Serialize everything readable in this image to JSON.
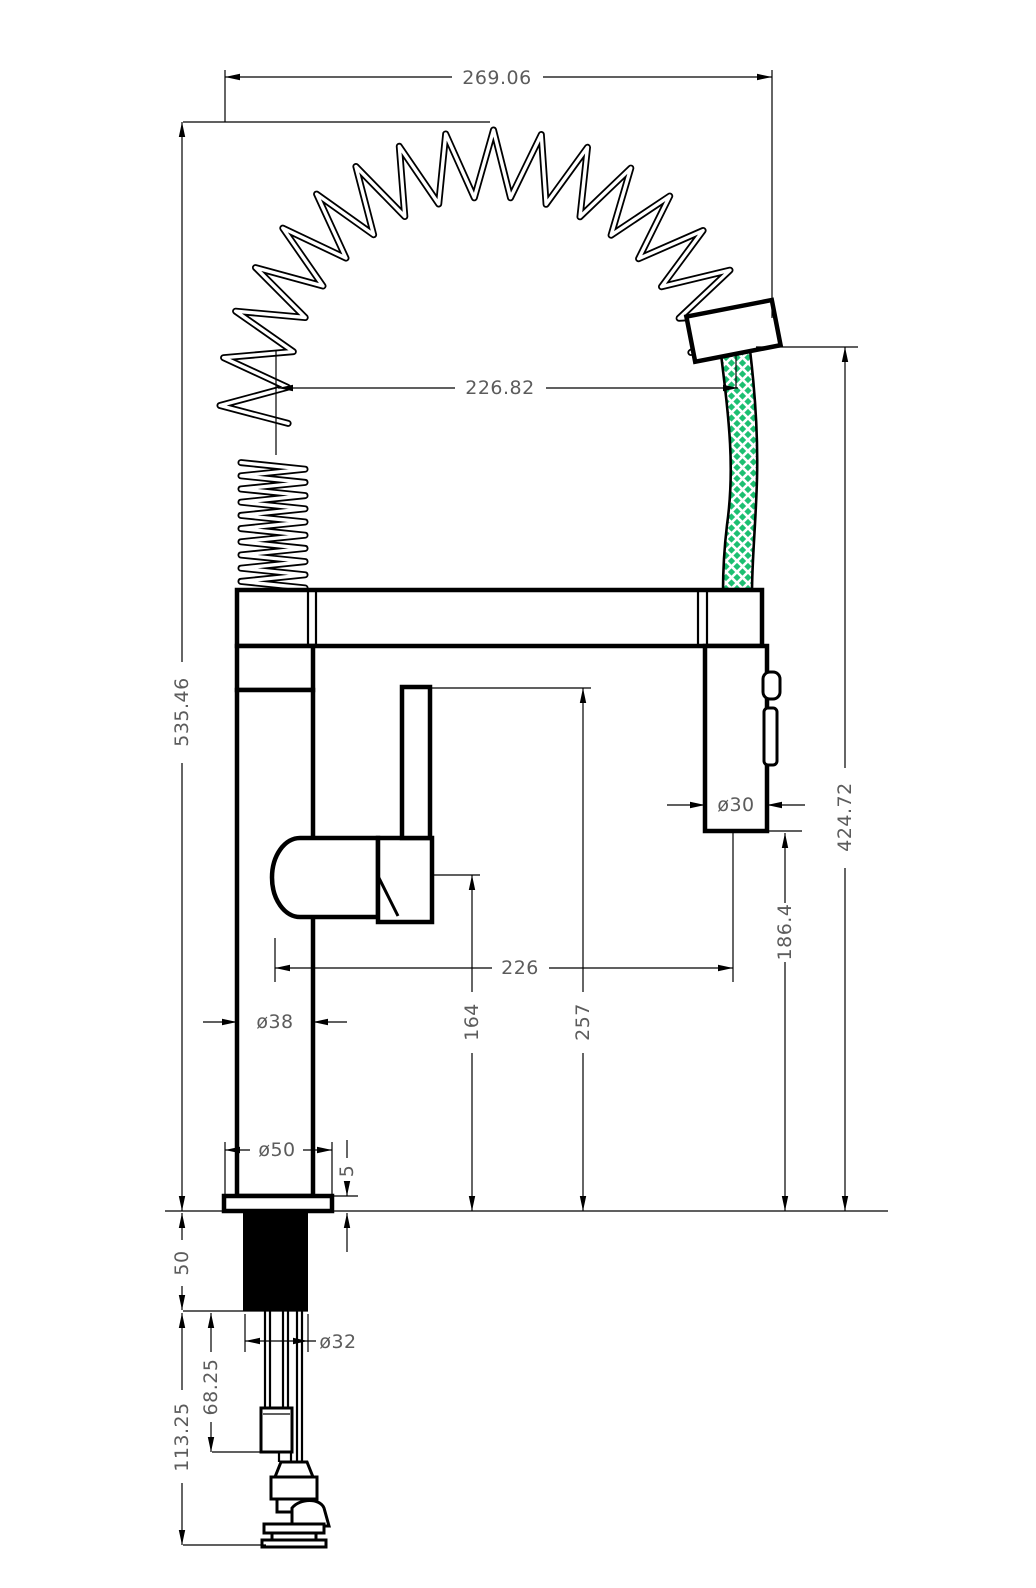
{
  "drawing": {
    "dims": {
      "overall_width": "269.06",
      "coil_to_hose_span": "226.82",
      "overall_height": "535.46",
      "hose_drop_height": "424.72",
      "sprayer_to_deck": "186.4",
      "spout_reach": "226",
      "handle_top_to_deck": "164",
      "spout_top_to_deck": "257",
      "body_diameter": "ø38",
      "base_diameter": "ø50",
      "sprayer_diameter": "ø30",
      "shank_diameter": "ø32",
      "base_plate_thickness": "5",
      "shank_length": "50",
      "connector_drop": "68.25",
      "under_deck_depth": "113.25"
    },
    "colors": {
      "hose_green": "#1dbf72",
      "line": "#000000",
      "dim_text": "#5c5c5c",
      "background": "#ffffff"
    }
  }
}
